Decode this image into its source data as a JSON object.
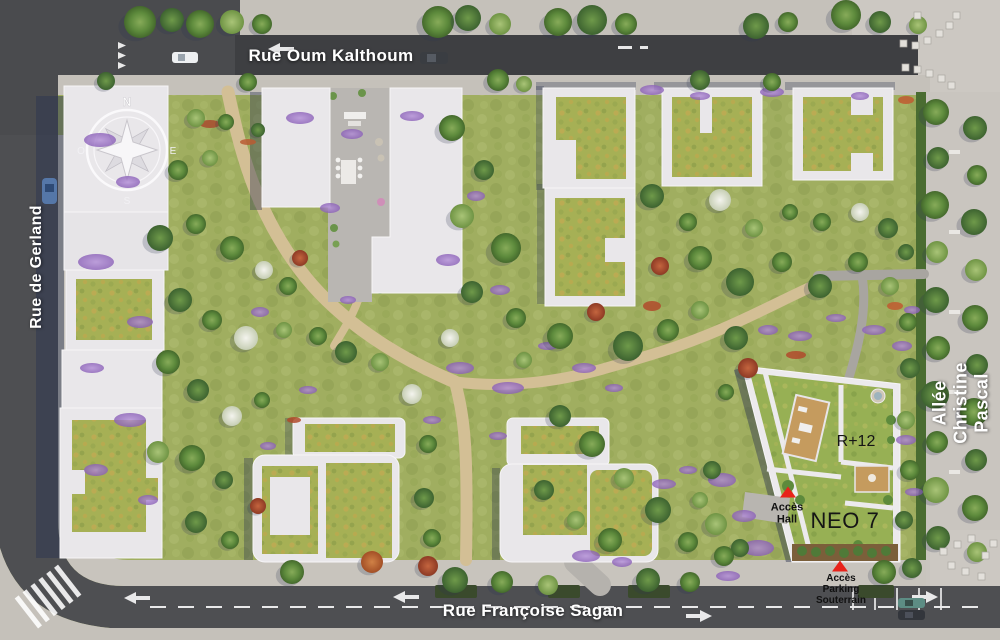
{
  "streets": {
    "top": {
      "label": "Rue Oum Kalthoum"
    },
    "left": {
      "label": "Rue de Gerland"
    },
    "right": {
      "label": "Allée Christine Pascal"
    },
    "bottom": {
      "label": "Rue Françoise Sagan"
    }
  },
  "building": {
    "name": "NEO 7",
    "floors_label": "R+12",
    "hall_access_label": "Accès\nHall",
    "parking_access_label": "Accès\nParking\nSouterrain"
  },
  "compass": {
    "north": "N",
    "east": "E",
    "south": "S",
    "west": "O"
  },
  "colors": {
    "access_marker_red": "#e8231a",
    "park_grass": "#a0ae60",
    "green_roof": "#a6b055",
    "building_roof_white": "#e9e7ea",
    "asphalt": "#4e4f52",
    "sidewalk": "#c5c1ba",
    "path_beige": "#d3bf95",
    "street_text": "#ffffff",
    "label_text_dark": "#151515"
  }
}
